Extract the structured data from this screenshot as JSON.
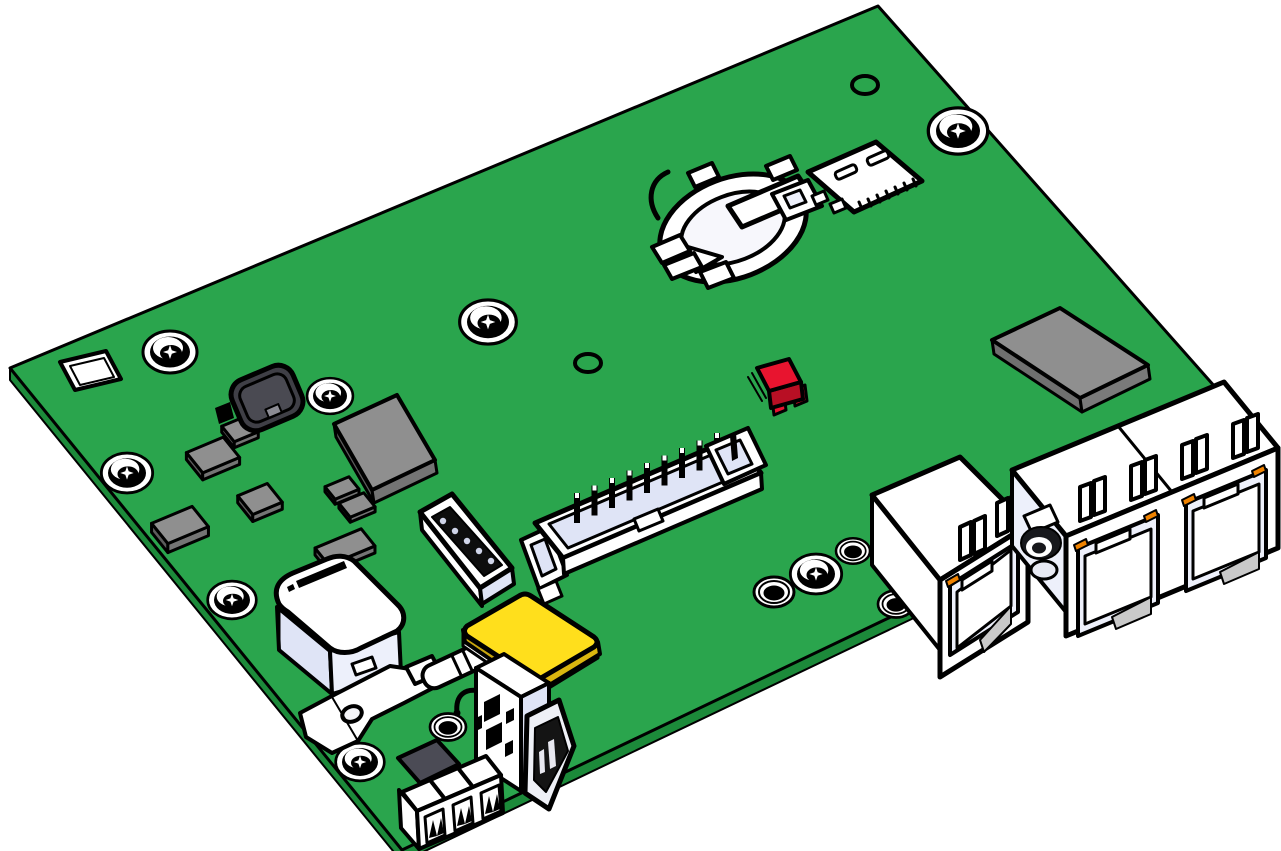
{
  "scene": {
    "subject": "Isometric CAD line-art rendering of a green printed circuit board with connectors",
    "background": "#ffffff"
  },
  "colors": {
    "pcb": "#2aa54d",
    "pcb_side": "#1c8a3a",
    "ink": "#000000",
    "white": "#ffffff",
    "lav": "#dfe4f6",
    "lav_light": "#edf0fb",
    "gray": "#8f8f8f",
    "gray_mid": "#747474",
    "gray_dark": "#5c5c5c",
    "charcoal": "#3f3f46",
    "slate": "#4b4b55",
    "yellow": "#ffdf1c",
    "yellow_side": "#c9a60e",
    "yellow_side2": "#dab60f",
    "red": "#e8142f",
    "red_side": "#b80f24",
    "orange": "#ef8200",
    "metal": "#eef0f6",
    "shadow": "#c9c9c9"
  },
  "board": {
    "outline": [
      [
        10,
        368
      ],
      [
        878,
        6
      ],
      [
        1262,
        440
      ],
      [
        402,
        850
      ]
    ],
    "screws": [
      {
        "x": 170,
        "y": 352,
        "s": 1.0
      },
      {
        "x": 330,
        "y": 396,
        "s": 0.85
      },
      {
        "x": 127,
        "y": 473,
        "s": 0.95
      },
      {
        "x": 232,
        "y": 600,
        "s": 0.9
      },
      {
        "x": 360,
        "y": 762,
        "s": 0.9
      },
      {
        "x": 488,
        "y": 322,
        "s": 1.05
      },
      {
        "x": 958,
        "y": 131,
        "s": 1.1
      },
      {
        "x": 816,
        "y": 574,
        "s": 0.95
      }
    ],
    "standoffs": [
      {
        "x": 774,
        "y": 592,
        "s": 1.0
      },
      {
        "x": 853,
        "y": 551,
        "s": 0.85
      },
      {
        "x": 896,
        "y": 604,
        "s": 0.9
      },
      {
        "x": 448,
        "y": 727,
        "s": 0.9
      }
    ],
    "vias": [
      {
        "x": 865,
        "y": 85
      },
      {
        "x": 588,
        "y": 363
      }
    ],
    "smd_chips": [
      {
        "cx": 213,
        "cy": 455,
        "w": 40,
        "h": 26,
        "d": 7
      },
      {
        "cx": 240,
        "cy": 429,
        "w": 26,
        "h": 20,
        "d": 6
      },
      {
        "cx": 260,
        "cy": 499,
        "w": 32,
        "h": 24,
        "d": 7
      },
      {
        "cx": 180,
        "cy": 525,
        "w": 44,
        "h": 26,
        "d": 9
      },
      {
        "cx": 342,
        "cy": 488,
        "w": 26,
        "h": 16,
        "d": 5
      },
      {
        "cx": 357,
        "cy": 505,
        "w": 27,
        "h": 18,
        "d": 5
      },
      {
        "cx": 345,
        "cy": 547,
        "w": 50,
        "h": 22,
        "d": 7
      }
    ]
  },
  "counts": {
    "header_pins": 9,
    "rj45_ports": 3,
    "terminal_positions": 3,
    "mounting_screws": 8,
    "standoffs": 4
  },
  "components": {
    "board": "green printed circuit board",
    "square_cutout": "square cutout hole",
    "mounting_screws": "mounting screws",
    "standoffs": "round standoffs",
    "vias": "through-hole vias",
    "smd_chips": "gray SMD chips",
    "inductor": "black power inductor",
    "main_ic": "main IC chip",
    "rf_module": "gray shield module",
    "red_led": "red indicator component",
    "battery_holder": "coin cell battery holder",
    "sim_slot": "micro SIM card slot",
    "pin_header": "shrouded pin header connector",
    "pin_socket": "single row pin socket",
    "supercap": "large white capacitor",
    "fuse": "cylindrical fuse with holder",
    "bracket": "metal mounting bracket",
    "yellow_chip": "yellow square component",
    "usb": "vertical USB-A connector",
    "terminal_block": "3-pin terminal block plug",
    "rj45_single": "single RJ45 ethernet jack",
    "rj45_dual": "dual RJ45 ethernet jack",
    "coax": "coaxial antenna connector"
  }
}
